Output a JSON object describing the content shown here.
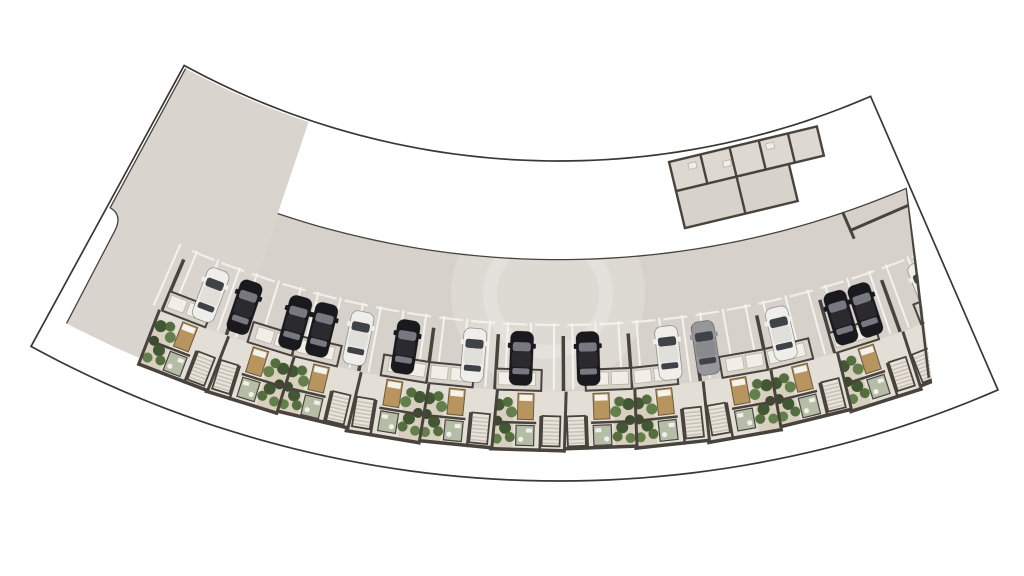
{
  "scene": {
    "width": 1024,
    "height": 576,
    "background": "#ffffff",
    "description": "curved residential site plan, top view"
  },
  "colors": {
    "background": "#ffffff",
    "boundary_line": "#3b3734",
    "wall": "#49433d",
    "drive_surface": "#d6d2cb",
    "pavilion_floor": "#d9d5ce",
    "bay_floor": "#cfcac2",
    "rooms_upper_floor": "#ddd8d0",
    "rooms_lower_floor": "#d7d3cb",
    "unit_floor": "#e4dfd6",
    "storage_floor": "#d8d3cb",
    "closet_box": "#f1eee8",
    "white_line": "#f4f3ef",
    "stair_base": "#e9e4db",
    "stair_tread": "#c8c2b6",
    "bed_body": "#b8945f",
    "bed_pillow": "#f4f2ec",
    "bed_outline": "#6b5a3e",
    "bath_floor": "#b5bda7",
    "bath_fixture": "#eef0e9",
    "garden_gravel": "#d8cfbe",
    "bush_greens": [
      "#3a512c",
      "#4e6838",
      "#5d7a45",
      "#2f4424"
    ],
    "watermark": "#ffffff",
    "car_palette": {
      "black": {
        "body": "#1a191d",
        "glass": "#787881",
        "roof": "#2a2a2f"
      },
      "white": {
        "body": "#efeeea",
        "glass": "#3f4246",
        "roof": "#e0dfda"
      },
      "gray": {
        "body": "#97969a",
        "glass": "#3f4246",
        "roof": "#8a898d"
      }
    }
  },
  "geometry": {
    "center": {
      "x": 559,
      "y": -622
    },
    "site": {
      "deg_left": -28.6,
      "deg_right": 23.45,
      "r_inner": 783,
      "r_outer": 1103,
      "line_width": 1.7
    },
    "strip": {
      "deg_left": -18.6,
      "deg_right": 23.25,
      "r_top": 881,
      "r_out_base": 1066,
      "right_out_deg": 20.3,
      "r_clip_out": 1078
    },
    "pavilion": {
      "deg_left": -28.45,
      "deg_right": -18.6,
      "deg_center": -23.5,
      "r_top": 785,
      "r_bottom": 898,
      "half_width": 74,
      "notch": {
        "deg_out": -27.55,
        "r1": 944,
        "r2": 962
      }
    },
    "rooms_band": {
      "deg_center": -13.5,
      "half_width": 76,
      "r_top": 788,
      "r_mid": 818,
      "r_bottom": 856,
      "lower_right_t": 40,
      "dividers_upper_t": [
        -45,
        -15,
        15,
        45
      ],
      "dividers_lower_t": [
        -15
      ],
      "closet_boxes": [
        [
          -58,
          794,
          8,
          6
        ],
        [
          -24,
          800,
          8,
          6
        ],
        [
          22,
          793,
          8,
          6
        ]
      ]
    }
  },
  "parking": {
    "stall_boundaries_start_deg": -27.45,
    "stall_step_deg": 3.885,
    "count": 13,
    "white_line": {
      "r1": 945,
      "r2": 1012,
      "w": 2,
      "pair_offset_deg": 0.55
    },
    "stub": {
      "r1": 958,
      "r2": 1013,
      "w": 3.5
    },
    "front_dash": {
      "r": 947,
      "half_len": 12,
      "w": 2.2
    }
  },
  "cars": {
    "row_radius": 981,
    "main_row": [
      {
        "deg": -23.5,
        "color": "black"
      },
      {
        "deg": -22.0,
        "color": "white"
      },
      {
        "deg": -18.2,
        "color": "black"
      },
      {
        "deg": -16.7,
        "color": "black"
      },
      {
        "deg": -13.1,
        "color": "white"
      },
      {
        "deg": -8.6,
        "color": "gray"
      },
      {
        "deg": -6.4,
        "color": "white"
      },
      {
        "deg": -1.7,
        "color": "black"
      },
      {
        "deg": 2.2,
        "color": "black"
      },
      {
        "deg": 5.0,
        "color": "white"
      },
      {
        "deg": 9.0,
        "color": "black"
      },
      {
        "deg": 11.8,
        "color": "white"
      },
      {
        "deg": 14.0,
        "color": "black"
      },
      {
        "deg": 15.6,
        "color": "black"
      },
      {
        "deg": 18.7,
        "color": "black"
      },
      {
        "deg": 20.8,
        "color": "white"
      }
    ],
    "pavilion_car": {
      "t": -18,
      "r": 820,
      "color": "black"
    }
  },
  "units": {
    "r_storage_top": 992,
    "r_back": 1013,
    "r_out_base": 1072,
    "half_width": 38,
    "shifts": [
      2,
      0,
      3,
      1,
      4,
      2,
      0,
      2,
      1,
      3,
      0,
      2,
      1
    ],
    "mirrors": [
      0,
      1,
      0,
      0,
      1,
      0,
      1,
      0,
      0,
      1,
      0,
      1,
      0
    ],
    "garden": {
      "t1": -36,
      "t2": -15,
      "r1": 1022
    },
    "bushes": [
      [
        -30,
        1028,
        6
      ],
      [
        -21,
        1025,
        5
      ],
      [
        -17,
        1035,
        5.5
      ],
      [
        -31,
        1044,
        5
      ],
      [
        -23,
        1051,
        6
      ],
      [
        -18,
        1060,
        5
      ],
      [
        -31,
        1062,
        5
      ]
    ],
    "bed": {
      "t": -11,
      "r": 1016,
      "w": 16,
      "h": 26
    },
    "bath": {
      "t": -12,
      "r": 1048,
      "w": 18,
      "h": 20
    },
    "stairs": {
      "t": 14,
      "r": 1038,
      "w": 18,
      "h": 30,
      "treads": 8
    },
    "storage": {
      "t1": -34,
      "t2": 12,
      "boxes": [
        [
          -31,
          995,
          17,
          13
        ],
        [
          -11,
          995,
          17,
          13
        ]
      ]
    }
  },
  "pavilion_interior": {
    "top_room": {
      "t1": -74,
      "t2": -48,
      "r1": 787,
      "r2": 812
    },
    "stall_bars": [
      [
        -33,
        792,
        3,
        70
      ],
      [
        -6,
        792,
        3,
        70
      ]
    ],
    "rooms_block": {
      "t1": 10,
      "t2": 74,
      "r1": 787,
      "r2": 860,
      "divider_t": 40,
      "mid_r": 825
    },
    "closet_boxes": [
      [
        16,
        798,
        8,
        6
      ],
      [
        44,
        792,
        8,
        6
      ]
    ],
    "stairs": {
      "t1": 42,
      "t2": 68,
      "r1": 838,
      "r2": 858,
      "treads": 9
    },
    "circles": [
      [
        52,
        874,
        8
      ],
      [
        67,
        864,
        7.5
      ]
    ]
  },
  "watermark": {
    "x": 548,
    "y": 294,
    "r_disc": 97,
    "disc_opacity": 0.18,
    "r_ring": 58,
    "ring_width": 14,
    "ring_opacity": 0.2
  }
}
